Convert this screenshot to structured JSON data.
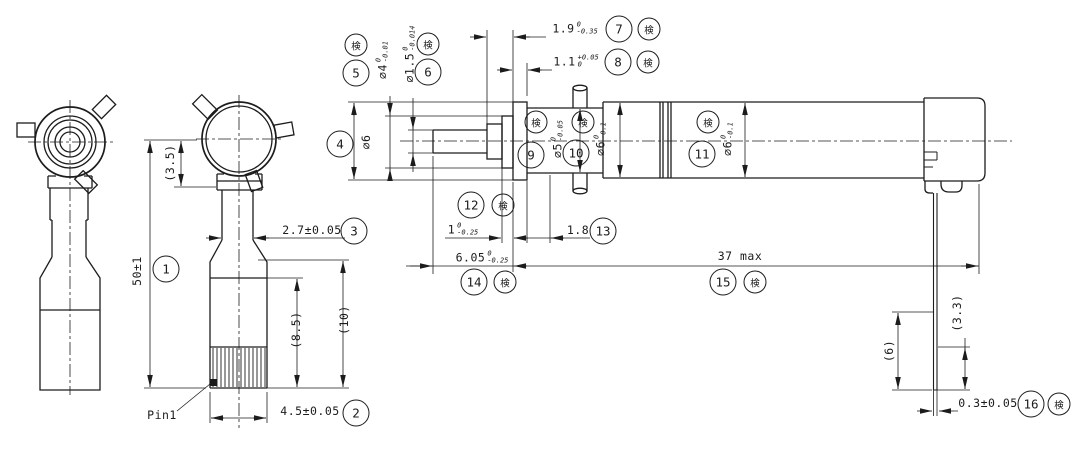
{
  "drawing": {
    "type": "mechanical-part-drawing",
    "part_label": "Pin1",
    "inspection_stamp": "検",
    "balloons": [
      "1",
      "2",
      "3",
      "4",
      "5",
      "6",
      "7",
      "8",
      "9",
      "10",
      "11",
      "12",
      "13",
      "14",
      "15",
      "16"
    ],
    "dims": {
      "d1": {
        "text": "50±1"
      },
      "d2": {
        "text": "4.5±0.05"
      },
      "d3": {
        "text": "2.7±0.05"
      },
      "d4": {
        "text": "⌀6"
      },
      "d5": {
        "value": "⌀4",
        "tol_top": "0",
        "tol_bot": "-0.01"
      },
      "d6": {
        "value": "⌀1.5",
        "tol_top": "0",
        "tol_bot": "-0.014"
      },
      "d7": {
        "value": "1.9",
        "tol_top": "0",
        "tol_bot": "-0.35"
      },
      "d8": {
        "value": "1.1",
        "tol_top": "+0.05",
        "tol_bot": "0"
      },
      "d9": {
        "value": "⌀5",
        "tol_top": "0",
        "tol_bot": "-0.05"
      },
      "d10": {
        "value": "⌀6",
        "tol_top": "0",
        "tol_bot": "-0.1"
      },
      "d11": {
        "value": "⌀6",
        "tol_top": "0",
        "tol_bot": "-0.1"
      },
      "d12": {
        "value": "1",
        "tol_top": "0",
        "tol_bot": "-0.25"
      },
      "d13": {
        "text": "1.8"
      },
      "d14": {
        "value": "6.05",
        "tol_top": "0",
        "tol_bot": "-0.25"
      },
      "d15": {
        "text": "37 max"
      },
      "d16": {
        "text": "0.3±0.05"
      },
      "ref_3_5": {
        "text": "(3.5)"
      },
      "ref_8_5": {
        "text": "(8.5)"
      },
      "ref_10": {
        "text": "(10)"
      },
      "ref_6": {
        "text": "(6)"
      },
      "ref_3_3": {
        "text": "(3.3)"
      }
    },
    "colors": {
      "line": "#1c1c1c",
      "background": "#ffffff"
    }
  }
}
